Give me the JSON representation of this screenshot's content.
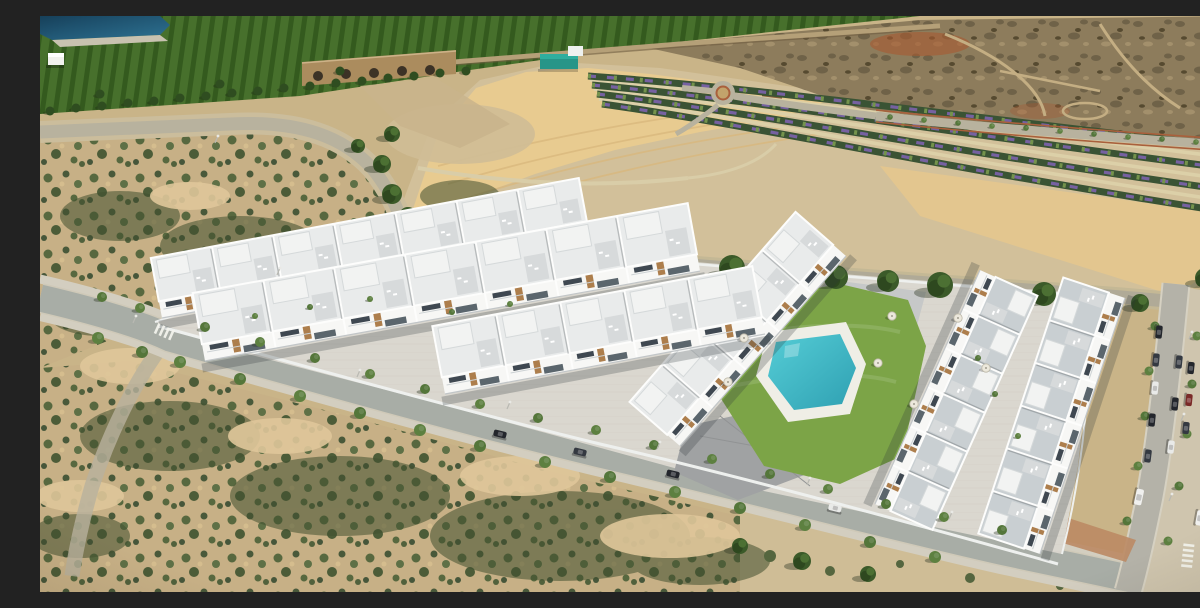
{
  "meta": {
    "description": "Aerial view of a modern white residential development with a communal turquoise pool, surrounded by arid scrubland, orchards, a reservoir, landscaped flower rows and tree-lined streets with parked cars"
  },
  "palette": {
    "sandBase": "#c9b488",
    "gravel": "#d2c09a",
    "sandGold": "#e8cb90",
    "goldStrip": "#e4c78e",
    "clearedLot": "#cfbd96",
    "scrubSand": "#c7b086",
    "orchard1": "#47702c",
    "orchard2": "#345a1e",
    "edgeTree": "#2f4d20",
    "waste1": "#8d7c5c",
    "waste2": "#6f6248",
    "waste3": "#a3906c",
    "dirtPath": "#c4ae83",
    "redSoil": "#a85a30",
    "redPath": "#a9603c",
    "wall": "#b5a078",
    "bridge": "#ab8c5e",
    "bridgeTop": "#cdb288",
    "arch": "#3c3226",
    "gully": "#c9b48c",
    "water1": "#16415c",
    "water2": "#2e7292",
    "rim": "#c8c2b0",
    "roadTan": "#b8b29e",
    "shoulder": "#cbbd9c",
    "avenue": "#b0aa97",
    "avenueShoulder": "#c4b895",
    "street": "#a8ada6",
    "street2": "#b4b2a8",
    "kerb": "#cfc9b8",
    "kerb2": "#d6d1c2",
    "sidewalk": "#d3cec0",
    "sidewalk2": "#cfc5ae",
    "redWalk": "#bb8a64",
    "pine1": "#3b5a29",
    "pine2": "#2e481f",
    "pine3": "#4c7033",
    "trunk": "#7a5c3e",
    "treeA": "#5d8040",
    "treeB": "#54763a",
    "treeShadow": "rgba(45,55,35,0.4)",
    "bedGreen": "#3a5334",
    "purple": "#7d63ad",
    "bedTree": "#74934c",
    "lawn": "#7ca447",
    "plaza": "#a0a2a3",
    "paveNE": "#c6c8c8",
    "deck": "#efeee6",
    "pool1": "#55cdd6",
    "pool2": "#2fa0b2",
    "complexPave": "#dad7cf",
    "facade": "#f7f7f5",
    "roofA": "#e9ebeb",
    "roofB": "#c9cfd2",
    "parapet": "#fdfdfc",
    "penthouse": "#f2f3f2",
    "penthouseEdge": "#d5d9da",
    "terrace": "#d7dadb",
    "windowDark": "#3f4851",
    "glass": "#5b666d",
    "wood": "#ad7e4c",
    "rail": "#cdd2d4",
    "baseline": "#c2c6c8",
    "wallWhite": "#eef0ee",
    "shadow": "rgba(45,50,55,0.25)",
    "teal": "#279588",
    "tealLight": "#2fae9e",
    "tealTop": "#eef1ef",
    "shedBrown": "#8a5f38",
    "white": "#ffffff",
    "signBlue": "#2a6fd4",
    "dumpBlue": "#3a6ea8",
    "crosswalk": "#f4f4ee",
    "lamp": "#e9e9e5"
  },
  "scene": {
    "building_rows": [
      {
        "name": "terrace-row-back-left",
        "x1": 122,
        "y1": 302,
        "x2": 550,
        "y2": 222,
        "depth": 44,
        "units": 7,
        "roof": "roofA"
      },
      {
        "name": "terrace-row-mid-left",
        "x1": 165,
        "y1": 345,
        "x2": 660,
        "y2": 255,
        "depth": 52,
        "units": 7,
        "roof": "roofA"
      },
      {
        "name": "terrace-row-far-right",
        "x1": 1000,
        "y1": 538,
        "x2": 1085,
        "y2": 282,
        "depth": 48,
        "units": 6,
        "roof": "roofB"
      },
      {
        "name": "terrace-row-pool-east",
        "x1": 940,
        "y1": 254,
        "x2": 835,
        "y2": 488,
        "depth": 46,
        "units": 6,
        "roof": "roofB"
      },
      {
        "name": "terrace-row-pool-west",
        "x1": 640,
        "y1": 430,
        "x2": 806,
        "y2": 240,
        "depth": 50,
        "units": 5,
        "roof": "roofA"
      },
      {
        "name": "terrace-row-front-left",
        "x1": 405,
        "y1": 378,
        "x2": 725,
        "y2": 318,
        "depth": 52,
        "units": 5,
        "roof": "roofA"
      }
    ],
    "street_trees": [
      [
        62,
        281,
        5
      ],
      [
        100,
        292,
        5
      ],
      [
        165,
        311,
        5
      ],
      [
        220,
        326,
        5
      ],
      [
        275,
        342,
        5
      ],
      [
        330,
        358,
        5
      ],
      [
        385,
        373,
        5
      ],
      [
        440,
        388,
        5
      ],
      [
        498,
        402,
        5
      ],
      [
        556,
        414,
        5
      ],
      [
        614,
        429,
        5
      ],
      [
        672,
        443,
        5
      ],
      [
        730,
        458,
        5
      ],
      [
        788,
        473,
        5
      ],
      [
        846,
        488,
        5
      ],
      [
        904,
        501,
        5
      ],
      [
        962,
        514,
        5
      ],
      [
        58,
        322,
        6
      ],
      [
        102,
        336,
        6
      ],
      [
        140,
        346,
        6
      ],
      [
        200,
        363,
        6
      ],
      [
        260,
        380,
        6
      ],
      [
        320,
        397,
        6
      ],
      [
        380,
        414,
        6
      ],
      [
        440,
        430,
        6
      ],
      [
        505,
        446,
        6
      ],
      [
        570,
        461,
        6
      ],
      [
        635,
        476,
        6
      ],
      [
        700,
        492,
        6
      ],
      [
        765,
        509,
        6
      ],
      [
        830,
        526,
        6
      ],
      [
        895,
        541,
        6
      ],
      [
        1115,
        310,
        4.5
      ],
      [
        1109,
        355,
        4.5
      ],
      [
        1105,
        400,
        4.5
      ],
      [
        1098,
        450,
        4.5
      ],
      [
        1087,
        505,
        4.5
      ],
      [
        1157,
        320,
        4.5
      ],
      [
        1152,
        368,
        4.5
      ],
      [
        1147,
        418,
        4.5
      ],
      [
        1139,
        470,
        4.5
      ],
      [
        1128,
        525,
        4.5
      ],
      [
        850,
        101,
        2.8
      ],
      [
        884,
        104,
        2.8
      ],
      [
        918,
        107,
        2.8
      ],
      [
        952,
        110,
        2.8
      ],
      [
        986,
        112,
        2.8
      ],
      [
        1020,
        115,
        2.8
      ],
      [
        1054,
        118,
        2.8
      ],
      [
        1088,
        121,
        2.8
      ],
      [
        1122,
        123,
        2.8
      ],
      [
        1156,
        126,
        2.8
      ],
      [
        1190,
        128,
        2.8
      ],
      [
        215,
        300,
        3
      ],
      [
        270,
        291,
        3
      ],
      [
        330,
        283,
        3
      ],
      [
        412,
        296,
        3
      ],
      [
        470,
        288,
        3
      ],
      [
        955,
        378,
        3
      ],
      [
        978,
        420,
        3
      ],
      [
        938,
        342,
        3
      ]
    ],
    "pines": [
      [
        390,
        224,
        10
      ],
      [
        428,
        228,
        12
      ],
      [
        466,
        232,
        9
      ],
      [
        505,
        236,
        12
      ],
      [
        545,
        240,
        10
      ],
      [
        590,
        243,
        13
      ],
      [
        640,
        248,
        11
      ],
      [
        692,
        252,
        13
      ],
      [
        744,
        257,
        10
      ],
      [
        796,
        261,
        12
      ],
      [
        848,
        265,
        11
      ],
      [
        900,
        269,
        13
      ],
      [
        952,
        274,
        10
      ],
      [
        1004,
        278,
        12
      ],
      [
        1056,
        282,
        10
      ],
      [
        1100,
        287,
        9
      ],
      [
        352,
        118,
        8
      ],
      [
        342,
        148,
        9
      ],
      [
        352,
        178,
        10
      ],
      [
        368,
        200,
        9
      ],
      [
        318,
        130,
        7
      ],
      [
        1165,
        262,
        10
      ],
      [
        1192,
        286,
        9
      ],
      [
        700,
        530,
        8
      ],
      [
        762,
        545,
        9
      ],
      [
        828,
        558,
        8
      ]
    ],
    "edge_trees": [
      [
        10,
        95
      ],
      [
        36,
        92
      ],
      [
        62,
        90
      ],
      [
        88,
        87
      ],
      [
        114,
        85
      ],
      [
        140,
        82
      ],
      [
        166,
        80
      ],
      [
        192,
        77
      ],
      [
        218,
        75
      ],
      [
        244,
        72
      ],
      [
        270,
        70
      ],
      [
        296,
        67
      ],
      [
        322,
        65
      ],
      [
        348,
        62
      ],
      [
        374,
        60
      ],
      [
        400,
        57
      ],
      [
        426,
        55
      ],
      [
        60,
        78
      ],
      [
        180,
        68
      ],
      [
        300,
        55
      ]
    ],
    "car_colors": {
      "d1": "#23262c",
      "d2": "#343941",
      "w": "#e9eae8",
      "v": "#f0f0ee",
      "r": "#7a2a28"
    },
    "cars": [
      [
        460,
        418,
        14,
        "d1",
        13
      ],
      [
        540,
        436,
        14,
        "d2",
        13
      ],
      [
        633,
        458,
        14,
        "d1",
        13
      ],
      [
        795,
        492,
        14,
        "w",
        13
      ],
      [
        1119,
        316,
        96,
        "d1",
        13
      ],
      [
        1116,
        344,
        96,
        "d2",
        13
      ],
      [
        1115,
        372,
        96,
        "w",
        13
      ],
      [
        1112,
        404,
        96,
        "d1",
        13
      ],
      [
        1108,
        440,
        97,
        "d2",
        13
      ],
      [
        1099,
        481,
        102,
        "v",
        16
      ],
      [
        1139,
        346,
        96,
        "d2",
        13
      ],
      [
        1135,
        388,
        96,
        "d1",
        13
      ],
      [
        1131,
        431,
        97,
        "w",
        13
      ],
      [
        1151,
        352,
        96,
        "d1",
        12
      ],
      [
        1149,
        384,
        96,
        "r",
        12
      ],
      [
        1146,
        412,
        96,
        "d2",
        12
      ],
      [
        1160,
        502,
        100,
        "v",
        15
      ]
    ],
    "lamps": [
      [
        320,
        354
      ],
      [
        470,
        386
      ],
      [
        620,
        426
      ],
      [
        770,
        462
      ],
      [
        912,
        496
      ],
      [
        1152,
        316
      ],
      [
        1144,
        398
      ],
      [
        1132,
        478
      ],
      [
        240,
        252
      ],
      [
        178,
        120
      ],
      [
        1165,
        556
      ],
      [
        96,
        300
      ]
    ],
    "umbrellas": [
      [
        852,
        300
      ],
      [
        838,
        347
      ],
      [
        874,
        388
      ],
      [
        704,
        322
      ],
      [
        688,
        366
      ],
      [
        918,
        302
      ],
      [
        946,
        352
      ]
    ],
    "crosswalks": [
      {
        "x": 116,
        "y": 312,
        "rot": 24,
        "n": 4
      },
      {
        "x": 1149,
        "y": 528,
        "rot": 96,
        "n": 5
      }
    ],
    "flower_rows": {
      "beds": [
        "M 548,60 C 720,72 900,98 1200,132",
        "M 552,69 C 720,84 900,116 1200,154",
        "M 557,78 C 720,97 900,134 1200,176",
        "M 562,88 C 720,110 900,152 1200,198"
      ],
      "paths": [
        "M 550,64 C 720,78 900,107 1200,143",
        "M 554,73 C 720,90 900,125 1200,165",
        "M 559,83 C 720,103 900,143 1200,187"
      ]
    }
  }
}
